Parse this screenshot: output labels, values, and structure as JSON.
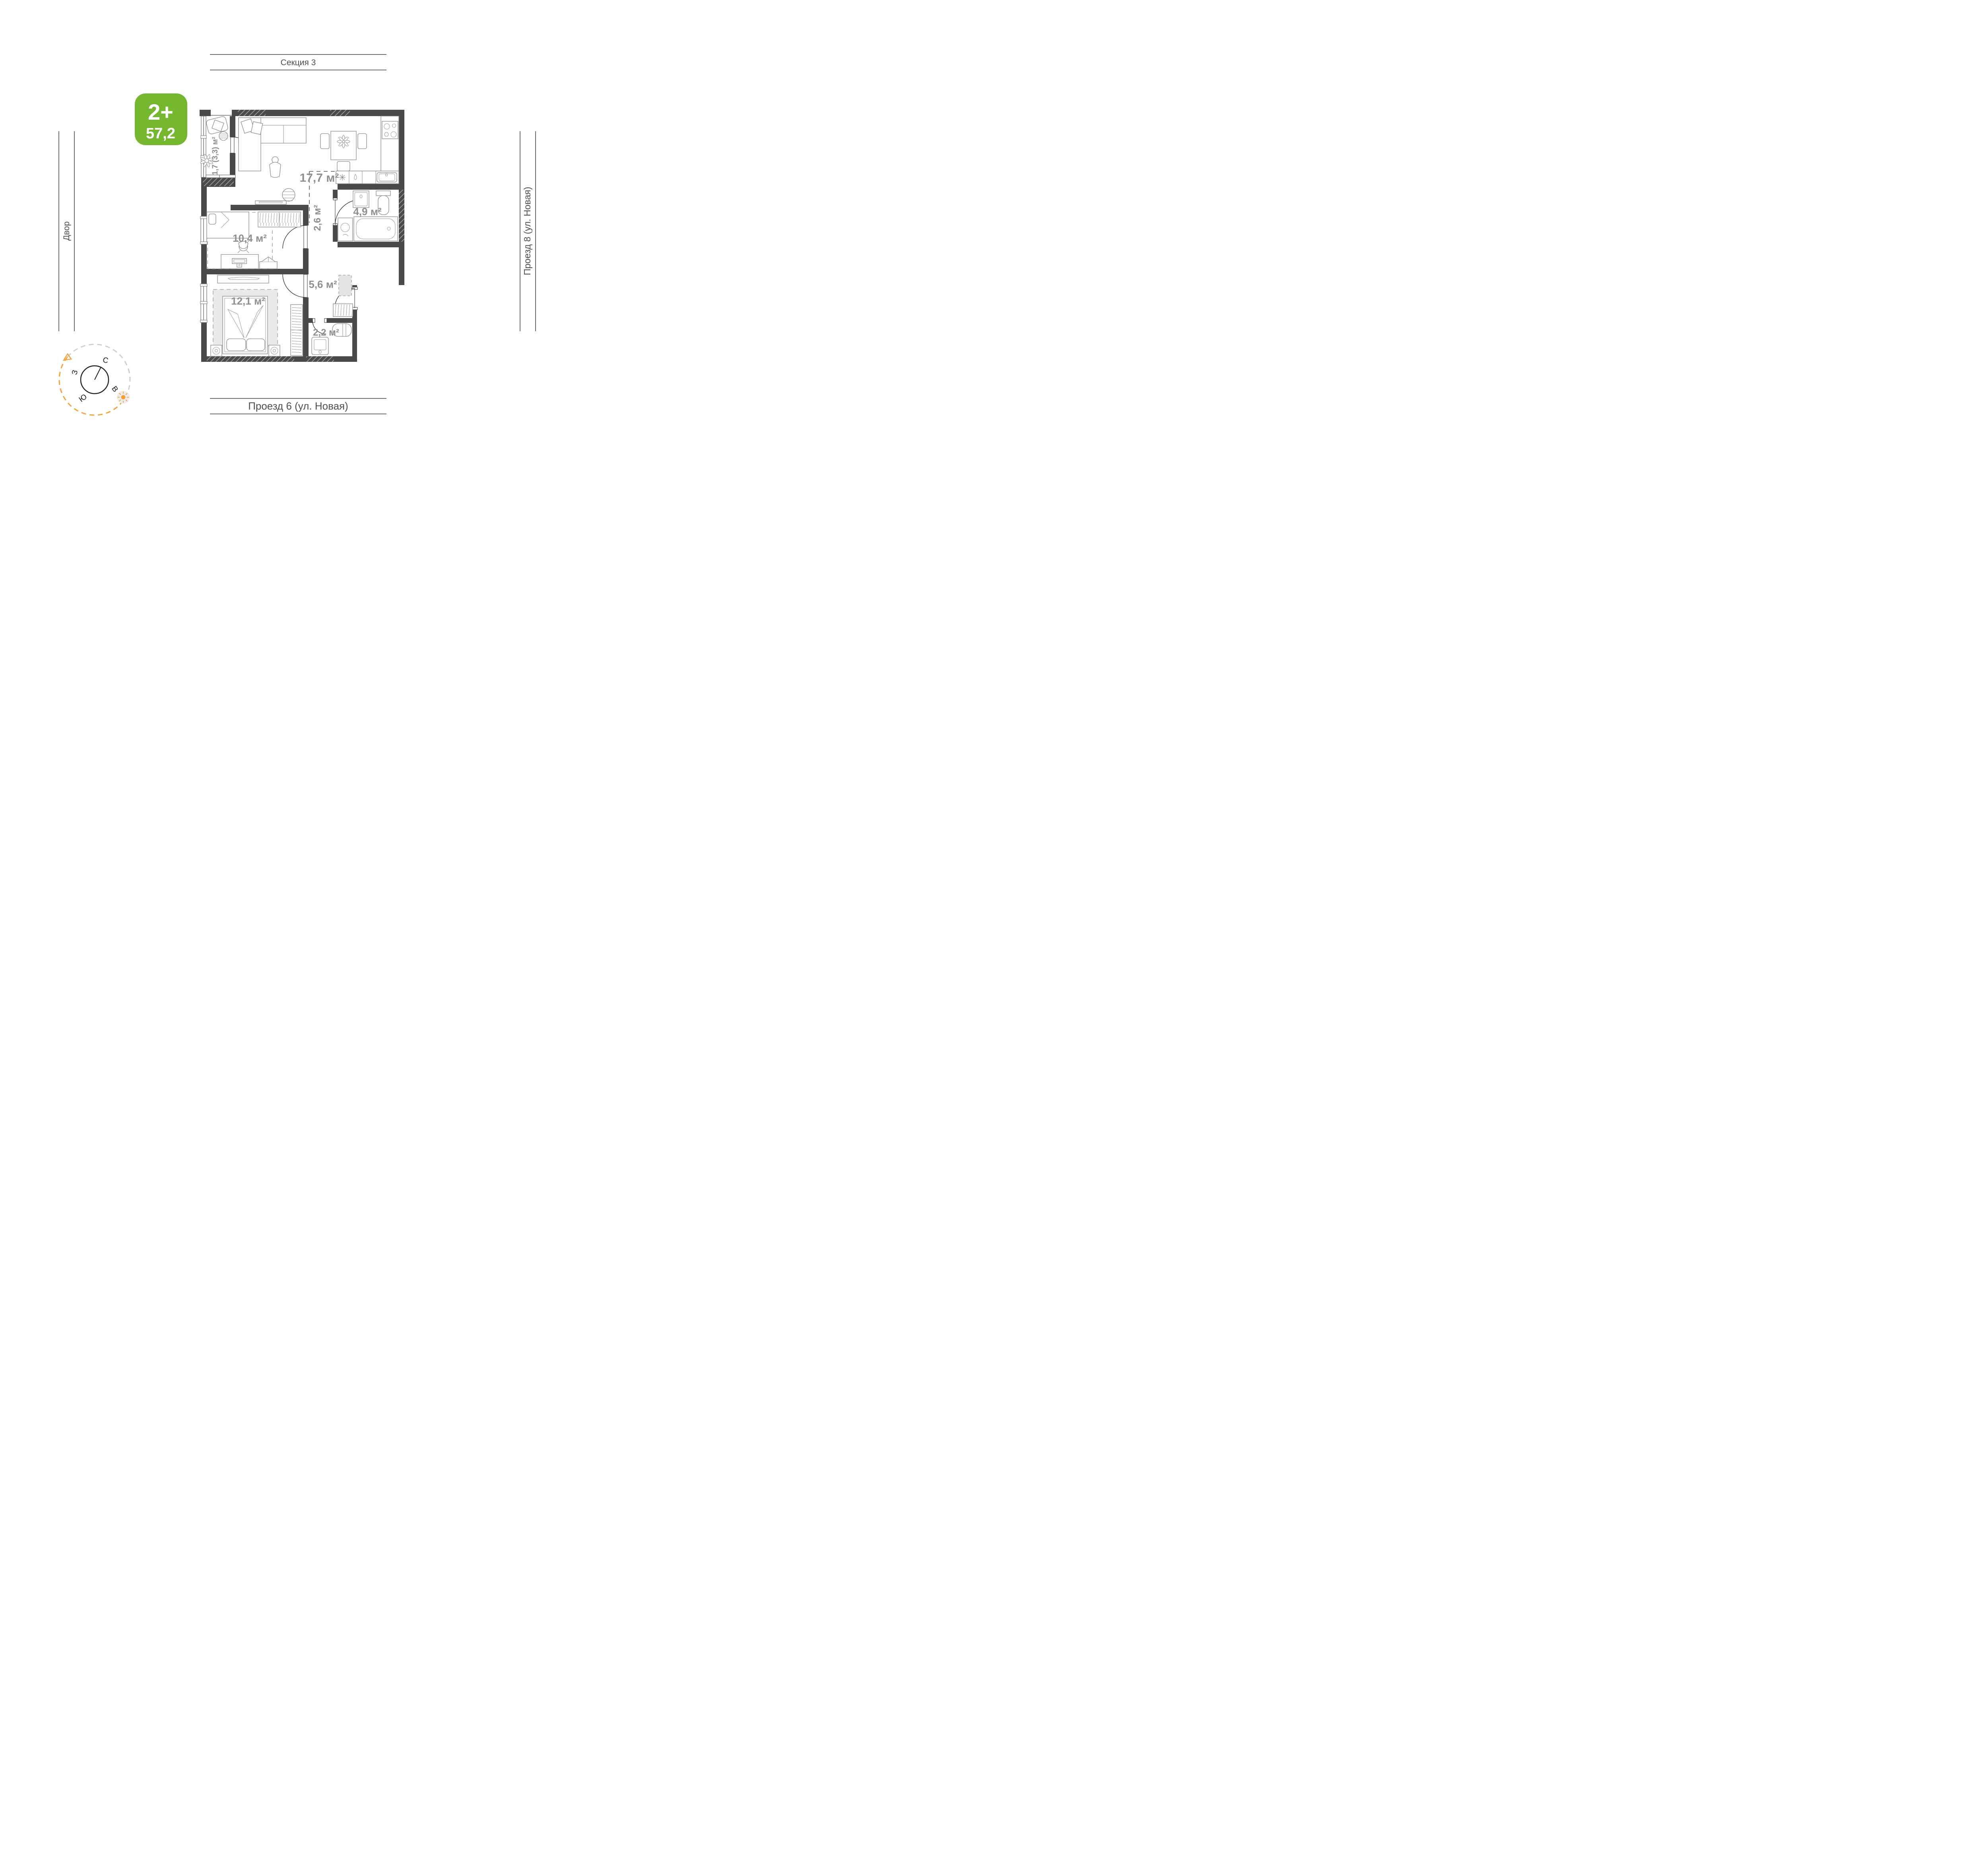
{
  "badge": {
    "rooms_label": "2+",
    "area_value": "57,2"
  },
  "guides": {
    "top": "Секция 3",
    "bottom": "Проезд 6 (ул. Новая)",
    "left": "Двор",
    "right": "Проезд 8 (ул. Новая)"
  },
  "rooms": [
    {
      "id": "living-kitchen",
      "area_label": "17,7 м²"
    },
    {
      "id": "balcony",
      "area_label": "1,7 (3,3) м²"
    },
    {
      "id": "hall",
      "area_label": "2,6 м²"
    },
    {
      "id": "bathroom",
      "area_label": "4,9 м²"
    },
    {
      "id": "bedroom-1",
      "area_label": "10,4 м²"
    },
    {
      "id": "corridor",
      "area_label": "5,6 м²"
    },
    {
      "id": "bedroom-2",
      "area_label": "12,1 м²"
    },
    {
      "id": "storage",
      "area_label": "2,2 м²"
    }
  ],
  "compass": {
    "north": "С",
    "south": "Ю",
    "west": "З",
    "east": "В"
  },
  "colors": {
    "badge_green": "#75b72e",
    "wall_dark": "#4a4a4a",
    "room_label_gray": "#8f8f8f",
    "guide_label_gray": "#4f4f4f",
    "sun_orange": "#f2a33c",
    "dash_gray": "#cfcfcf"
  }
}
